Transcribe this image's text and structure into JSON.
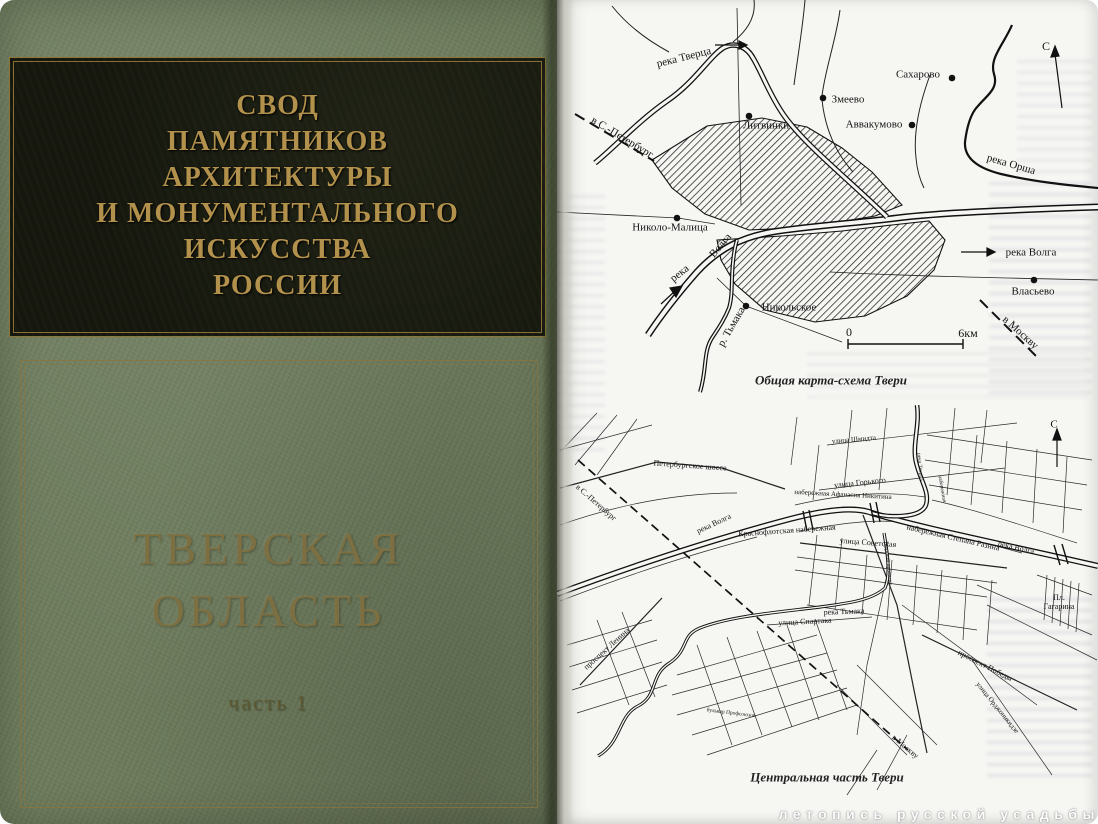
{
  "cover": {
    "series_title_lines": [
      "СВОД",
      "ПАМЯТНИКОВ",
      "АРХИТЕКТУРЫ",
      "И МОНУМЕНТАЛЬНОГО",
      "ИСКУССТВА",
      "РОССИИ"
    ],
    "region_lines": [
      "ТВЕРСКАЯ",
      "ОБЛАСТЬ"
    ],
    "part_label": "часть 1",
    "colors": {
      "cover_green": "#6f7d5e",
      "panel_black": "#15170e",
      "gold_title": "#b2914c",
      "gold_frame": "#8f7538",
      "region_gold": "#7e7040"
    }
  },
  "page": {
    "watermark": "летопись русской усадьбы",
    "maps": [
      {
        "caption": "Общая карта-схема Твери",
        "labels": [
          {
            "text": "река Тверца"
          },
          {
            "text": "в С.-Петербург"
          },
          {
            "text": "Литвинки"
          },
          {
            "text": "Змеево"
          },
          {
            "text": "Сахарово"
          },
          {
            "text": "Аввакумово"
          },
          {
            "text": "река Орша"
          },
          {
            "text": "С"
          },
          {
            "text": "Николо-Малица"
          },
          {
            "text": "река"
          },
          {
            "text": "Волга"
          },
          {
            "text": "Никольское"
          },
          {
            "text": "р. Тьмака"
          },
          {
            "text": "река Волга"
          },
          {
            "text": "Власьево"
          },
          {
            "text": "в Москву"
          },
          {
            "text": "0"
          },
          {
            "text": "6км"
          }
        ]
      },
      {
        "caption": "Центральная часть Твери",
        "labels": [
          {
            "text": "Петербургское шоссе"
          },
          {
            "text": "в С.-Петербург"
          },
          {
            "text": "река Волга"
          },
          {
            "text": "Краснофлотская набережная"
          },
          {
            "text": "улица Шмидта"
          },
          {
            "text": "улица Горького"
          },
          {
            "text": "набережная Афанасия Никитина"
          },
          {
            "text": "улица Советская"
          },
          {
            "text": "набережная Степана Разина"
          },
          {
            "text": "река Волга"
          },
          {
            "text": "река Тверца"
          },
          {
            "text": "набережная"
          },
          {
            "text": "Пл. Гагарина"
          },
          {
            "text": "проспект Ленина"
          },
          {
            "text": "улица Спартака"
          },
          {
            "text": "река Тьмака"
          },
          {
            "text": "проспект Победы"
          },
          {
            "text": "улица Орджоникидзе"
          },
          {
            "text": "в Москву"
          },
          {
            "text": "С"
          },
          {
            "text": "бульвар Профсоюзов"
          },
          {
            "text": "Тверской проспект"
          }
        ]
      }
    ]
  }
}
